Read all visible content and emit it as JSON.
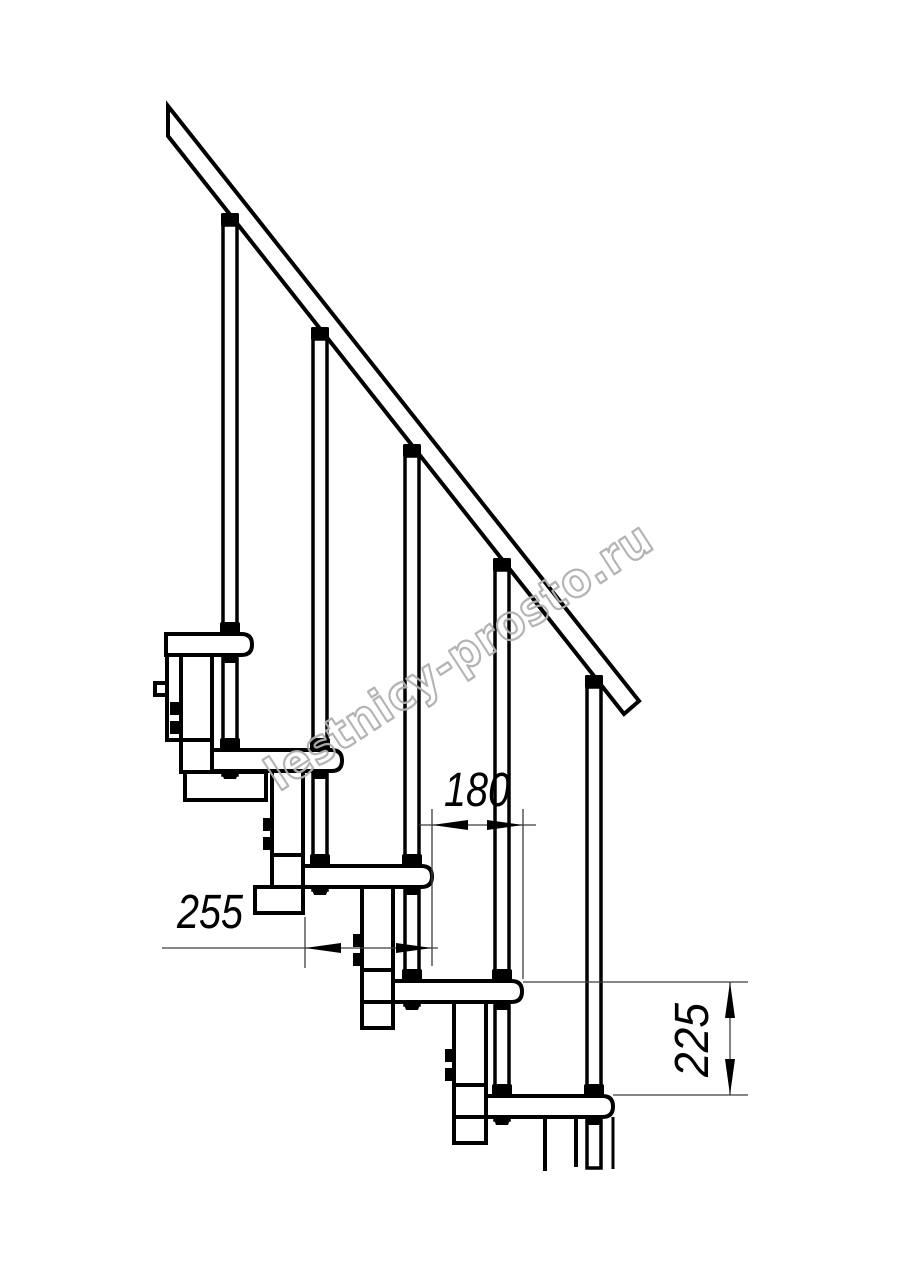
{
  "drawing_title": "modular-staircase-side-elevation",
  "dimensions": [
    {
      "id": "dim-180",
      "value": "180",
      "orientation": "horizontal"
    },
    {
      "id": "dim-255",
      "value": "255",
      "orientation": "horizontal"
    },
    {
      "id": "dim-225",
      "value": "225",
      "orientation": "vertical"
    }
  ],
  "watermark": {
    "text": "lestnicy-prosto.ru",
    "color": "#b0b0b0"
  },
  "colors": {
    "outline": "#000000",
    "dimension_line": "#3d3d3d",
    "background": "#ffffff"
  }
}
